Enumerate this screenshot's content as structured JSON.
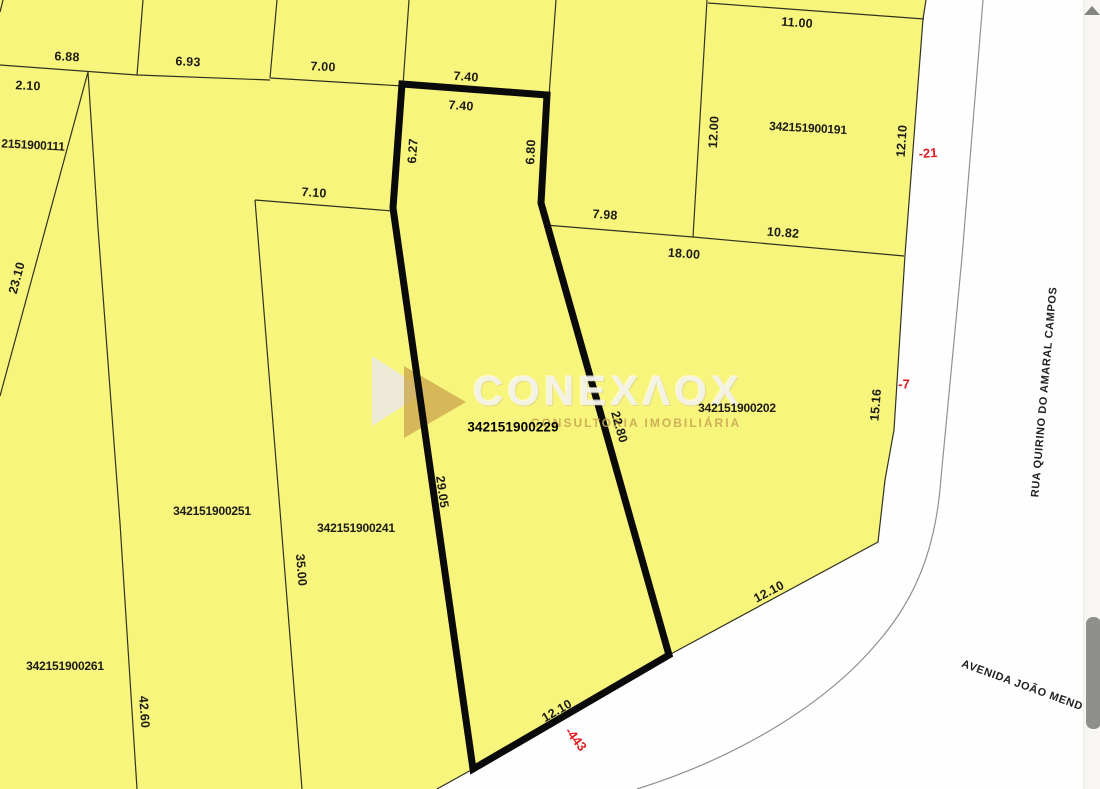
{
  "colors": {
    "parcel_fill": "#f8f57d",
    "line": "#32321f",
    "bold_line": "#0a0a0a",
    "street_line": "#909090",
    "ink": "#1c1c16",
    "ref": "#e3191e",
    "sb_track": "#f7f6f3",
    "sb_thumb": "#8e8e8c",
    "sb_arrow": "#83837f"
  },
  "watermark": {
    "title": "CONEXΛOX",
    "subtitle": "CONSULTORIA IMOBILIÁRIA"
  },
  "highlighted_parcel_id": "342151900229",
  "labels": [
    {
      "name": "dim-6-88",
      "text": "6.88",
      "x": 67,
      "y": 57,
      "r": 3,
      "cls": "dim"
    },
    {
      "name": "dim-6-93",
      "text": "6.93",
      "x": 188,
      "y": 62,
      "r": 3,
      "cls": "dim"
    },
    {
      "name": "dim-7-00",
      "text": "7.00",
      "x": 323,
      "y": 67,
      "r": 3,
      "cls": "dim"
    },
    {
      "name": "dim-7-40-outer",
      "text": "7.40",
      "x": 466,
      "y": 77,
      "r": 4,
      "cls": "dim"
    },
    {
      "name": "dim-7-40-inner",
      "text": "7.40",
      "x": 461,
      "y": 106,
      "r": 4,
      "cls": "dim"
    },
    {
      "name": "dim-11-00",
      "text": "11.00",
      "x": 797,
      "y": 23,
      "r": 4,
      "cls": "dim"
    },
    {
      "name": "dim-2-10",
      "text": "2.10",
      "x": 28,
      "y": 86,
      "r": 3,
      "cls": "dim"
    },
    {
      "name": "parcel-id-2151900111",
      "text": "2151900111",
      "x": 33,
      "y": 145,
      "r": 3,
      "cls": "id"
    },
    {
      "name": "dim-12-00",
      "text": "12.00",
      "x": 714,
      "y": 132,
      "r": -87,
      "cls": "dim"
    },
    {
      "name": "parcel-id-342151900191",
      "text": "342151900191",
      "x": 808,
      "y": 128,
      "r": 3,
      "cls": "id"
    },
    {
      "name": "dim-12-10-right",
      "text": "12.10",
      "x": 902,
      "y": 141,
      "r": -86,
      "cls": "dim"
    },
    {
      "name": "street-ref-minus-21",
      "text": "-21",
      "x": 928,
      "y": 153,
      "r": -4,
      "cls": "ref"
    },
    {
      "name": "dim-6-27",
      "text": "6.27",
      "x": 413,
      "y": 151,
      "r": -86,
      "cls": "dim"
    },
    {
      "name": "dim-6-80",
      "text": "6.80",
      "x": 531,
      "y": 152,
      "r": -87,
      "cls": "dim"
    },
    {
      "name": "dim-7-10",
      "text": "7.10",
      "x": 314,
      "y": 193,
      "r": 4,
      "cls": "dim"
    },
    {
      "name": "dim-7-98",
      "text": "7.98",
      "x": 605,
      "y": 215,
      "r": 4,
      "cls": "dim"
    },
    {
      "name": "dim-10-82",
      "text": "10.82",
      "x": 783,
      "y": 233,
      "r": 4,
      "cls": "dim"
    },
    {
      "name": "dim-18-00",
      "text": "18.00",
      "x": 684,
      "y": 254,
      "r": 4,
      "cls": "dim"
    },
    {
      "name": "dim-23-10",
      "text": "23.10",
      "x": 17,
      "y": 278,
      "r": -75,
      "cls": "dim"
    },
    {
      "name": "parcel-id-342151900202",
      "text": "342151900202",
      "x": 737,
      "y": 408,
      "r": 0,
      "cls": "id"
    },
    {
      "name": "dim-15-16",
      "text": "15.16",
      "x": 876,
      "y": 405,
      "r": -85,
      "cls": "dim"
    },
    {
      "name": "street-ref-minus-7",
      "text": "-7",
      "x": 904,
      "y": 384,
      "r": 0,
      "cls": "ref"
    },
    {
      "name": "parcel-id-342151900229",
      "text": "342151900229",
      "x": 513,
      "y": 427,
      "r": 0,
      "cls": "id-strong"
    },
    {
      "name": "dim-22-80",
      "text": "22.80",
      "x": 619,
      "y": 427,
      "r": 74,
      "cls": "dim"
    },
    {
      "name": "dim-29-05",
      "text": "29.05",
      "x": 442,
      "y": 492,
      "r": 82,
      "cls": "dim"
    },
    {
      "name": "parcel-id-342151900251",
      "text": "342151900251",
      "x": 212,
      "y": 511,
      "r": 0,
      "cls": "id"
    },
    {
      "name": "parcel-id-342151900241",
      "text": "342151900241",
      "x": 356,
      "y": 528,
      "r": 0,
      "cls": "id"
    },
    {
      "name": "dim-35-00",
      "text": "35.00",
      "x": 301,
      "y": 570,
      "r": 85,
      "cls": "dim"
    },
    {
      "name": "dim-12-10-upper",
      "text": "12.10",
      "x": 769,
      "y": 592,
      "r": -28,
      "cls": "dim"
    },
    {
      "name": "parcel-id-342151900261",
      "text": "342151900261",
      "x": 65,
      "y": 666,
      "r": 0,
      "cls": "id"
    },
    {
      "name": "dim-42-60",
      "text": "42.60",
      "x": 144,
      "y": 712,
      "r": 86,
      "cls": "dim"
    },
    {
      "name": "dim-12-10-lower",
      "text": "12.10",
      "x": 557,
      "y": 711,
      "r": -30,
      "cls": "dim"
    },
    {
      "name": "street-ref-minus-443",
      "text": "-443",
      "x": 576,
      "y": 739,
      "r": 52,
      "cls": "ref"
    },
    {
      "name": "street-name-rua-quirino-do-amaral-campos",
      "text": "RUA QUIRINO DO AMARAL CAMPOS",
      "x": 1045,
      "y": 392,
      "r": -85,
      "cls": "street"
    },
    {
      "name": "street-name-avenida-joao",
      "text": "AVENIDA JOÃO MEND",
      "x": 1022,
      "y": 686,
      "r": 20,
      "cls": "street"
    }
  ]
}
